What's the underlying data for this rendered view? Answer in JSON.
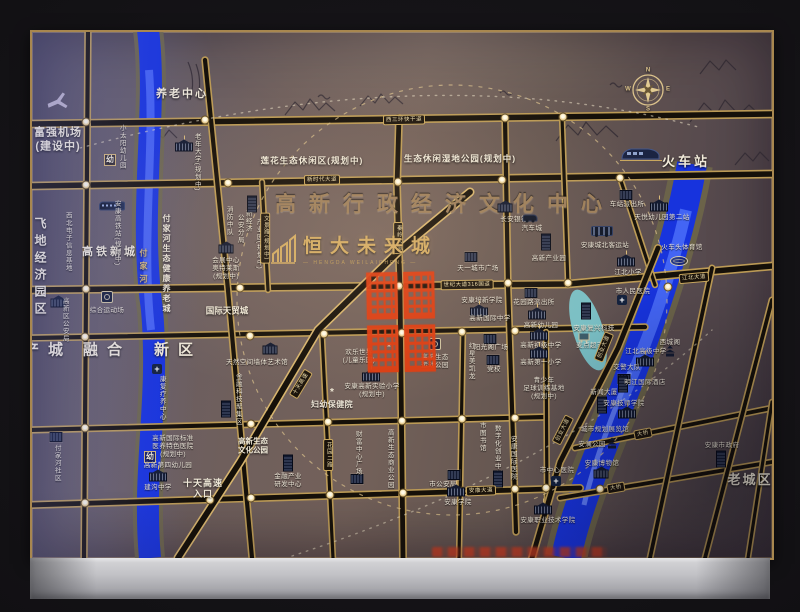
{
  "map": {
    "project": {
      "name": "恒大未来城",
      "latin": "— HENGDA WEILAICHENG —"
    },
    "icon_glyphs": {
      "hosp": "+",
      "flo": "*"
    },
    "region_labels": [
      {
        "t": "富强机场\n(建设中)",
        "x": 58,
        "y": 140,
        "fs": 11,
        "ls": 1
      },
      {
        "t": "养老中心",
        "x": 182,
        "y": 95,
        "fs": 11,
        "ls": 2
      },
      {
        "t": "莲花生态休闲区(规划中)",
        "x": 312,
        "y": 161,
        "fs": 8.5,
        "ls": 1
      },
      {
        "t": "生态休闲湿地公园(规划中)",
        "x": 460,
        "y": 159,
        "fs": 8.5,
        "ls": 1
      },
      {
        "t": "高新行政经济文化中心",
        "x": 445,
        "y": 205,
        "fs": 21,
        "ls": 13,
        "cls": "bronze"
      },
      {
        "t": "火车站",
        "x": 686,
        "y": 162,
        "fs": 13,
        "ls": 3
      },
      {
        "t": "飞地经济园区",
        "x": 40,
        "y": 268,
        "fs": 12,
        "ls": 5,
        "v": 1
      },
      {
        "t": "高铁新城",
        "x": 110,
        "y": 253,
        "fs": 11,
        "ls": 3
      },
      {
        "t": "产城",
        "x": 48,
        "y": 351,
        "fs": 15,
        "ls": 9
      },
      {
        "t": "融合",
        "x": 107,
        "y": 351,
        "fs": 15,
        "ls": 9
      },
      {
        "t": "新区",
        "x": 178,
        "y": 351,
        "fs": 15,
        "ls": 9
      },
      {
        "t": "老城区",
        "x": 750,
        "y": 480,
        "fs": 13,
        "ls": 2
      },
      {
        "t": "付家河",
        "x": 143,
        "y": 268,
        "fs": 8,
        "ls": 5,
        "v": 1,
        "cls": "gold"
      },
      {
        "t": "付家河生态健康养老城",
        "x": 166,
        "y": 264,
        "fs": 8,
        "ls": 2,
        "v": 1
      },
      {
        "t": "十天高速\n入口",
        "x": 203,
        "y": 489,
        "fs": 9,
        "ls": 1
      },
      {
        "t": "高新生态\n文化公园",
        "x": 253,
        "y": 446,
        "fs": 7.5
      },
      {
        "t": "国际天贸城",
        "x": 227,
        "y": 311,
        "fs": 8.5
      },
      {
        "t": "幼",
        "x": 110,
        "y": 160,
        "fs": 8,
        "cls": "kbadge"
      },
      {
        "t": "幼",
        "x": 150,
        "y": 457,
        "fs": 8,
        "cls": "kbadge"
      },
      {
        "t": "N",
        "x": 648,
        "y": 71,
        "fs": 6,
        "cls": "cl"
      },
      {
        "t": "E",
        "x": 668,
        "y": 90,
        "fs": 6,
        "cls": "cl"
      },
      {
        "t": "S",
        "x": 648,
        "y": 110,
        "fs": 6,
        "cls": "cl"
      },
      {
        "t": "W",
        "x": 628,
        "y": 90,
        "fs": 6,
        "cls": "cl"
      }
    ],
    "pois": [
      {
        "t": "小太阳幼儿园",
        "x": 121,
        "y": 147,
        "v": 1
      },
      {
        "t": "老年大学(规划中)",
        "x": 196,
        "y": 162,
        "v": 1,
        "i": "sch",
        "ix": 184,
        "iy": 147
      },
      {
        "t": "西北电子信息基地",
        "x": 67,
        "y": 242,
        "v": 1
      },
      {
        "t": "安康高铁站(规划中)",
        "x": 116,
        "y": 233,
        "v": 1,
        "i": "train",
        "ix": 112,
        "iy": 206
      },
      {
        "t": "消防中队",
        "x": 228,
        "y": 221,
        "v": 1
      },
      {
        "t": "公安分局",
        "x": 239,
        "y": 229,
        "v": 1
      },
      {
        "t": "新经济",
        "x": 247,
        "y": 221,
        "v": 1
      },
      {
        "t": "产业园(规划中)",
        "x": 258,
        "y": 244,
        "v": 1,
        "i": "tb",
        "ix": 252,
        "iy": 204
      },
      {
        "t": "会展中心\n奥特莱斯\n(规划中)",
        "x": 226,
        "y": 269,
        "i": "bank",
        "ix": 226,
        "iy": 249
      },
      {
        "t": "综合运动场",
        "x": 107,
        "y": 311,
        "i": "ball",
        "ix": 107,
        "iy": 297
      },
      {
        "t": "高新区公安局",
        "x": 64,
        "y": 320,
        "v": 1,
        "i": "bank",
        "ix": 58,
        "iy": 303
      },
      {
        "t": "付家河社区",
        "x": 56,
        "y": 463,
        "v": 1,
        "i": "b",
        "ix": 56,
        "iy": 437
      },
      {
        "t": "康复疗养中心",
        "x": 161,
        "y": 398,
        "v": 1,
        "i": "hosp",
        "ix": 157,
        "iy": 369
      },
      {
        "t": "高新国际标准\n医养特色医院\n(规划中)",
        "x": 173,
        "y": 447
      },
      {
        "t": "高新第四幼儿园",
        "x": 168,
        "y": 466
      },
      {
        "t": "建沟中学",
        "x": 158,
        "y": 488,
        "i": "sch",
        "ix": 158,
        "iy": 477
      },
      {
        "t": "金融科技聚集区",
        "x": 237,
        "y": 399,
        "v": 1,
        "i": "tb",
        "ix": 226,
        "iy": 409
      },
      {
        "t": "天然空间墙体艺术馆",
        "x": 257,
        "y": 363,
        "i": "bank",
        "ix": 270,
        "iy": 350
      },
      {
        "t": "金融产业\n研发中心",
        "x": 288,
        "y": 481,
        "i": "tb",
        "ix": 288,
        "iy": 463
      },
      {
        "t": "长安银行",
        "x": 514,
        "y": 220,
        "i": "bank",
        "ix": 505,
        "iy": 208
      },
      {
        "t": "汽车城",
        "x": 532,
        "y": 229,
        "i": "car",
        "ix": 530,
        "iy": 218
      },
      {
        "t": "高新产业园",
        "x": 549,
        "y": 259,
        "i": "tb",
        "ix": 546,
        "iy": 242
      },
      {
        "t": "安康城北客运站",
        "x": 605,
        "y": 246,
        "i": "bus",
        "ix": 602,
        "iy": 231
      },
      {
        "t": "车站派出所",
        "x": 627,
        "y": 205,
        "i": "b",
        "ix": 626,
        "iy": 195
      },
      {
        "t": "天悦幼儿园第二站",
        "x": 662,
        "y": 218,
        "i": "sch",
        "ix": 659,
        "iy": 207
      },
      {
        "t": "火车头体育馆",
        "x": 682,
        "y": 248,
        "i": "stad",
        "ix": 679,
        "iy": 261
      },
      {
        "t": "江北小学",
        "x": 628,
        "y": 273,
        "i": "sch",
        "ix": 626,
        "iy": 262
      },
      {
        "t": "市人民医院",
        "x": 633,
        "y": 292,
        "i": "hosp",
        "ix": 622,
        "iy": 300
      },
      {
        "t": "天一城市广场",
        "x": 478,
        "y": 269,
        "i": "b",
        "ix": 471,
        "iy": 257
      },
      {
        "t": "花园路派出所",
        "x": 534,
        "y": 303,
        "i": "b",
        "ix": 531,
        "iy": 293
      },
      {
        "t": "安康培新学院",
        "x": 482,
        "y": 301
      },
      {
        "t": "高新国际中学",
        "x": 490,
        "y": 319,
        "i": "sch",
        "ix": 479,
        "iy": 312
      },
      {
        "t": "高新幼儿园",
        "x": 541,
        "y": 326,
        "i": "sch",
        "ix": 537,
        "iy": 315
      },
      {
        "t": "红星美凯龙",
        "x": 470,
        "y": 361,
        "v": 1
      },
      {
        "t": "党校",
        "x": 494,
        "y": 370,
        "i": "b",
        "ix": 493,
        "iy": 360
      },
      {
        "t": "阳光阁广场",
        "x": 491,
        "y": 348,
        "i": "b",
        "ix": 490,
        "iy": 339
      },
      {
        "t": "欢乐世界\n(儿童乐园)",
        "x": 359,
        "y": 357,
        "i": "flo",
        "ix": 389,
        "iy": 348
      },
      {
        "t": "高新生态\n运动公园",
        "x": 435,
        "y": 362,
        "i": "ball",
        "ix": 435,
        "iy": 344
      },
      {
        "t": "妇幼保健院",
        "x": 332,
        "y": 405,
        "i": "flo",
        "ix": 332,
        "iy": 393,
        "fs": 8,
        "b": 1
      },
      {
        "t": "安康高新实验小学\n(规划中)",
        "x": 372,
        "y": 391,
        "i": "sch",
        "ix": 371,
        "iy": 377
      },
      {
        "t": "财富中心广场",
        "x": 357,
        "y": 453,
        "v": 1,
        "i": "b",
        "ix": 357,
        "iy": 479
      },
      {
        "t": "高新生态商业公园",
        "x": 389,
        "y": 459,
        "v": 1
      },
      {
        "t": "市图书馆",
        "x": 481,
        "y": 437,
        "v": 1
      },
      {
        "t": "数字化创业中心",
        "x": 496,
        "y": 451,
        "v": 1
      },
      {
        "t": "安康国际医院",
        "x": 512,
        "y": 458,
        "v": 1,
        "i": "tb",
        "ix": 498,
        "iy": 479
      },
      {
        "t": "市公安局",
        "x": 443,
        "y": 485,
        "i": "b",
        "ix": 454,
        "iy": 475
      },
      {
        "t": "市中心医院",
        "x": 557,
        "y": 471,
        "i": "hosp",
        "ix": 556,
        "iy": 481
      },
      {
        "t": "安康学院",
        "x": 458,
        "y": 503,
        "i": "sch",
        "ix": 456,
        "iy": 492
      },
      {
        "t": "安康职业技术学院",
        "x": 548,
        "y": 521,
        "i": "sch",
        "ix": 543,
        "iy": 510
      },
      {
        "t": "麦点超市",
        "x": 590,
        "y": 346,
        "i": "cart",
        "ix": 584,
        "iy": 337
      },
      {
        "t": "安康复兴科技",
        "x": 594,
        "y": 329,
        "i": "tb",
        "ix": 586,
        "iy": 311
      },
      {
        "t": "高新初级中学",
        "x": 541,
        "y": 346,
        "i": "sch",
        "ix": 539,
        "iy": 336
      },
      {
        "t": "高新第一小学",
        "x": 541,
        "y": 363,
        "i": "sch",
        "ix": 539,
        "iy": 354
      },
      {
        "t": "青少年\n足球训练基地\n(规划中)",
        "x": 544,
        "y": 389
      },
      {
        "t": "江北高级中学",
        "x": 646,
        "y": 352,
        "i": "sch",
        "ix": 645,
        "iy": 362
      },
      {
        "t": "西城阁",
        "x": 670,
        "y": 343,
        "i": "pag",
        "ix": 670,
        "iy": 355
      },
      {
        "t": "交警大队",
        "x": 627,
        "y": 368,
        "i": "b",
        "ix": 624,
        "iy": 379
      },
      {
        "t": "明江国际酒店",
        "x": 645,
        "y": 383,
        "i": "tb",
        "ix": 623,
        "iy": 384
      },
      {
        "t": "新闻大厦",
        "x": 604,
        "y": 393,
        "i": "tb",
        "ix": 602,
        "iy": 405
      },
      {
        "t": "安康技师学院",
        "x": 624,
        "y": 404,
        "i": "sch",
        "ix": 627,
        "iy": 414
      },
      {
        "t": "城市规划展览馆",
        "x": 605,
        "y": 430
      },
      {
        "t": "安澜公园",
        "x": 592,
        "y": 445,
        "i": "pag",
        "ix": 612,
        "iy": 447
      },
      {
        "t": "安康博物馆",
        "x": 602,
        "y": 464,
        "i": "bank",
        "ix": 601,
        "iy": 474
      },
      {
        "t": "安康市政府",
        "x": 722,
        "y": 446,
        "i": "tb",
        "ix": 721,
        "iy": 459
      }
    ],
    "road_badges": [
      {
        "t": "西三环快干道",
        "x": 404,
        "y": 120,
        "r": -1
      },
      {
        "t": "新时代大道",
        "x": 322,
        "y": 180,
        "r": -1
      },
      {
        "t": "秦岭大道",
        "x": 398,
        "y": 238,
        "v": 1
      },
      {
        "t": "世纪大道316国道",
        "x": 467,
        "y": 285,
        "r": -1
      },
      {
        "t": "江北大道",
        "x": 694,
        "y": 278,
        "r": -5
      },
      {
        "t": "安康大道",
        "x": 481,
        "y": 491,
        "r": -2
      },
      {
        "t": "创业大道",
        "x": 604,
        "y": 347,
        "r": -68
      },
      {
        "t": "创业大道",
        "x": 563,
        "y": 430,
        "r": -63
      },
      {
        "t": "十天高速",
        "x": 301,
        "y": 384,
        "r": -59
      },
      {
        "t": "花园二路",
        "x": 328,
        "y": 455,
        "v": 1
      },
      {
        "t": "文景路(规划中)",
        "x": 265,
        "y": 238,
        "v": 1
      },
      {
        "t": "大桥",
        "x": 643,
        "y": 434,
        "r": -11
      },
      {
        "t": "大桥",
        "x": 616,
        "y": 488,
        "r": -10
      }
    ],
    "intersections": [
      [
        86,
        122
      ],
      [
        205,
        120
      ],
      [
        398,
        119
      ],
      [
        505,
        118
      ],
      [
        563,
        117
      ],
      [
        86,
        185
      ],
      [
        228,
        183
      ],
      [
        398,
        182
      ],
      [
        502,
        180
      ],
      [
        620,
        178
      ],
      [
        86,
        289
      ],
      [
        240,
        288
      ],
      [
        399,
        286
      ],
      [
        508,
        283
      ],
      [
        568,
        283
      ],
      [
        85,
        337
      ],
      [
        250,
        336
      ],
      [
        324,
        334
      ],
      [
        402,
        333
      ],
      [
        462,
        332
      ],
      [
        515,
        331
      ],
      [
        85,
        428
      ],
      [
        251,
        424
      ],
      [
        328,
        422
      ],
      [
        402,
        421
      ],
      [
        462,
        419
      ],
      [
        515,
        418
      ],
      [
        85,
        503
      ],
      [
        210,
        500
      ],
      [
        251,
        498
      ],
      [
        330,
        495
      ],
      [
        403,
        493
      ],
      [
        462,
        491
      ],
      [
        515,
        489
      ],
      [
        546,
        488
      ],
      [
        640,
        436
      ],
      [
        600,
        489
      ],
      [
        668,
        287
      ]
    ]
  }
}
